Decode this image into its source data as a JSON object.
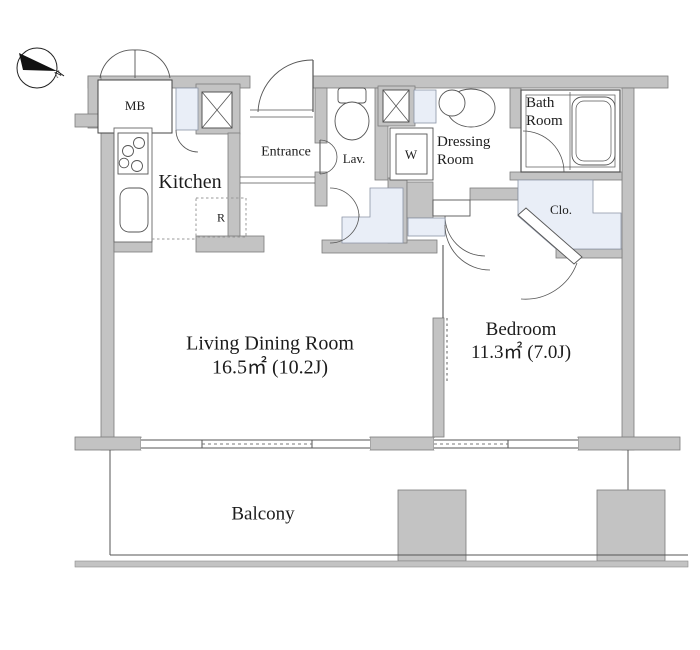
{
  "plan": {
    "compass_label": "N",
    "labels": {
      "meter_box": "MB",
      "kitchen": "Kitchen",
      "entrance": "Entrance",
      "lavatory": "Lav.",
      "washer": "W",
      "refrigerator": "R",
      "dressing_room": "Dressing\nRoom",
      "bath_room": "Bath\nRoom",
      "closet": "Clo.",
      "living_block": "Living Dining Room\n16.5㎡ (10.2J)",
      "bedroom_block": "Bedroom\n11.3㎡ (7.0J)",
      "balcony": "Balcony"
    },
    "rooms": [
      {
        "name": "Living Dining Room",
        "area_sqm": "16.5㎡",
        "area_tatami": "10.2J"
      },
      {
        "name": "Bedroom",
        "area_sqm": "11.3㎡",
        "area_tatami": "7.0J"
      }
    ],
    "colors": {
      "wall_fill": "#c3c3c3",
      "wall_stroke": "#7c7c7c",
      "fixture_line": "#555555",
      "closet_fill": "#e9eef7",
      "text": "#1c1c1c"
    }
  }
}
